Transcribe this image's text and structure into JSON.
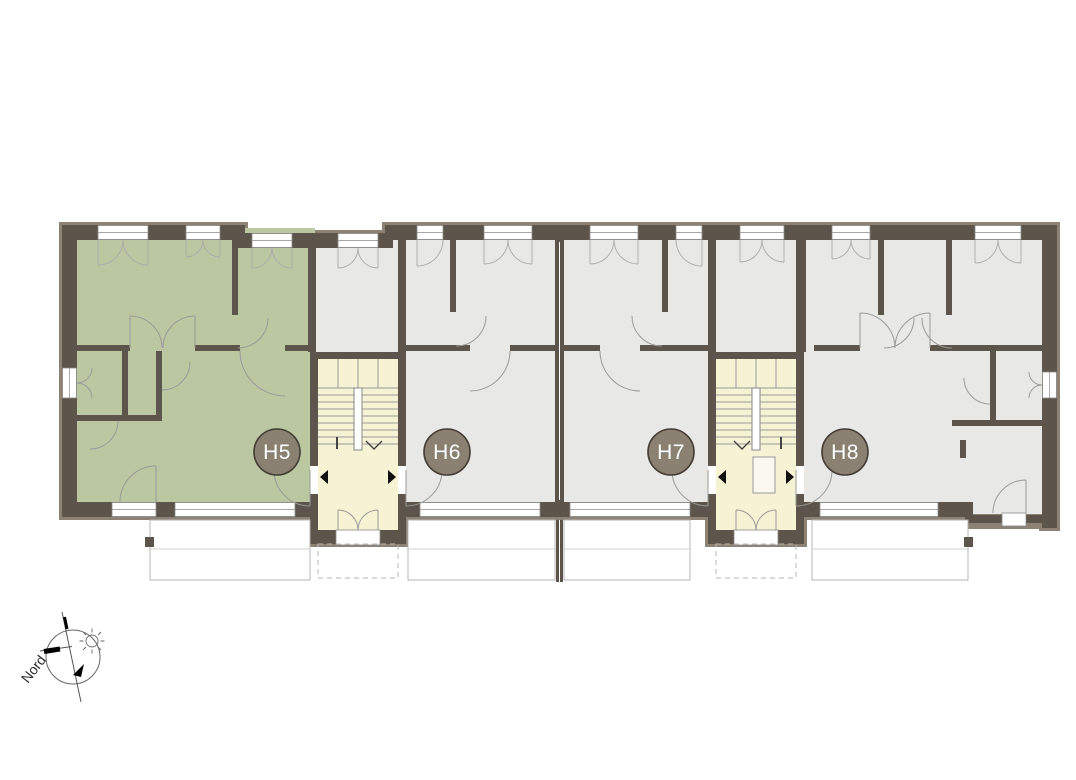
{
  "plan": {
    "units": [
      {
        "label": "H5",
        "highlighted": true,
        "fill": "#bac7a1"
      },
      {
        "label": "H6",
        "highlighted": false,
        "fill": "#e8e8e6"
      },
      {
        "label": "H7",
        "highlighted": false,
        "fill": "#e8e8e6"
      },
      {
        "label": "H8",
        "highlighted": false,
        "fill": "#e8e8e6"
      }
    ],
    "badge": {
      "fill": "#8b8173",
      "border": "#453e37",
      "text_color": "#ffffff"
    },
    "colors": {
      "wall": "#5d554b",
      "wall_outer_band": "#8e8275",
      "stairwell_fill": "#f6f2d4",
      "room_gray": "#e8e8e6",
      "room_green": "#bac7a1",
      "door_arc_line": "#9a9a9a",
      "terrace_outline": "#b6b6b4"
    },
    "compass": {
      "label": "Nord"
    }
  }
}
